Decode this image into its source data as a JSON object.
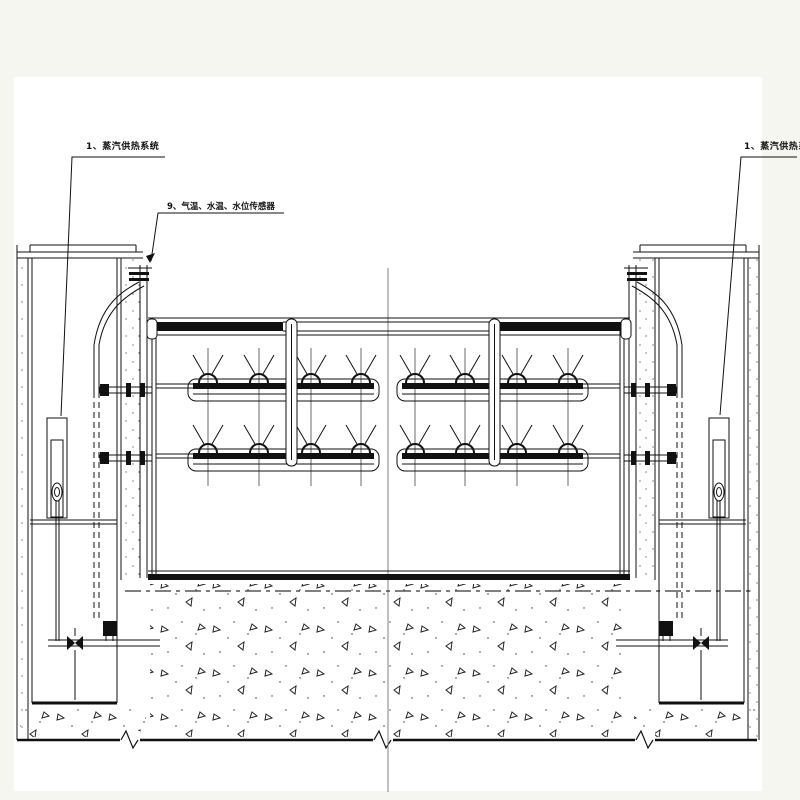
{
  "drawing": {
    "labels": {
      "steam_system_left": "1、蒸汽供热系统",
      "steam_system_right": "1、蒸汽供热系统",
      "sensors": "9、气温、水温、水位传感器"
    },
    "colors": {
      "paper": "#ffffff",
      "margin": "#f4f6ef",
      "ink": "#111111",
      "centerline": "#808080"
    }
  }
}
